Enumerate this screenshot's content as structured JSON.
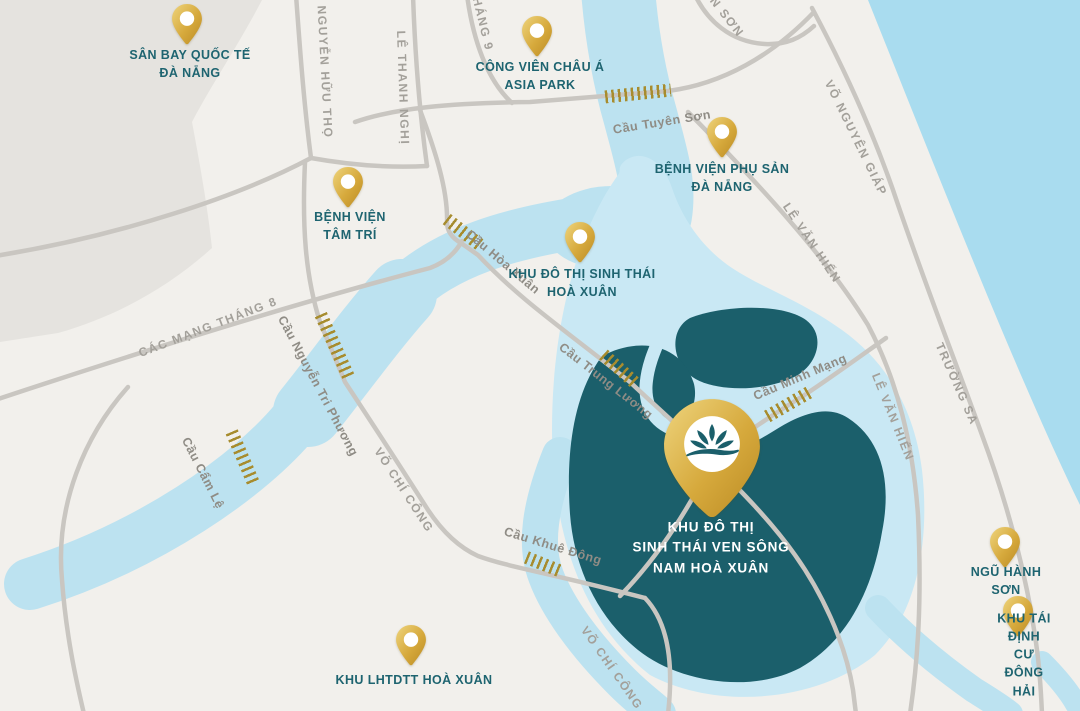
{
  "map_title": "Sơ đồ vị trí Khu đô thị sinh thái ven sông Nam Hoà Xuân - Đà Nẵng",
  "pois": {
    "airport": {
      "label": "SÂN BAY QUỐC TẾ\nĐÀ NẴNG"
    },
    "asia_park": {
      "label": "CÔNG VIÊN CHÂU Á\nASIA PARK"
    },
    "phu_san_hospital": {
      "label": "BỆNH VIỆN PHỤ SẢN\nĐÀ NẴNG"
    },
    "tam_tri_hospital": {
      "label": "BỆNH VIỆN\nTÂM TRÍ"
    },
    "hoa_xuan_eco": {
      "label": "KHU ĐÔ THỊ SINH THÁI\nHOÀ XUÂN"
    },
    "ngu_hanh_son": {
      "label": "NGŨ HÀNH SƠN"
    },
    "dong_hai": {
      "label": "KHU TÁI ĐỊNH CƯ\nĐÔNG HẢI"
    },
    "lhtdtt": {
      "label": "KHU LHTDTT HOÀ XUÂN"
    },
    "project": {
      "label": "KHU ĐÔ THỊ\nSINH THÁI VEN SÔNG\nNAM HOÀ XUÂN"
    }
  },
  "roads": {
    "nguyen_huu_tho": {
      "label": "NGUYỄN HỮU THỌ"
    },
    "le_thanh_nghi": {
      "label": "LÊ THANH NGHỊ"
    },
    "thang_9": {
      "label": "HÁNG 9"
    },
    "n_son": {
      "label": "N SƠN"
    },
    "vo_nguyen_giap": {
      "label": "VÕ NGUYÊN GIÁP"
    },
    "le_van_hien_n": {
      "label": "LÊ VĂN HIẾN"
    },
    "le_van_hien_s": {
      "label": "LÊ VĂN HIẾN"
    },
    "truong_sa": {
      "label": "TRƯỜNG SA"
    },
    "cach_mang_thang_8": {
      "label": "CÁC MẠNG THÁNG 8"
    },
    "vo_chi_cong_mid": {
      "label": "VÕ CHÍ CÔNG"
    },
    "vo_chi_cong_bot": {
      "label": "VÕ CHÍ CÔNG"
    }
  },
  "bridges": {
    "tuyen_son": {
      "label": "Cầu Tuyên Sơn"
    },
    "hoa_xuan": {
      "label": "Cầu Hòa Xuân"
    },
    "nguyen_tri_phuong": {
      "label": "Cầu Nguyễn Tri Phương"
    },
    "cam_le": {
      "label": "Cầu Cẩm Lệ"
    },
    "trung_luong": {
      "label": "Cầu Trung Lương"
    },
    "minh_mang": {
      "label": "Cầu Minh Mạng"
    },
    "khue_dong": {
      "label": "Cầu Khuê Đông"
    }
  },
  "colors": {
    "land": "#f2f0ec",
    "airport_zone": "#e5e3df",
    "sea": "#a9dcef",
    "river": "#bce2f0",
    "halo": "#c9e8f4",
    "project_area": "#1b5f6b",
    "road": "#c9c6c1",
    "pin_gold_light": "#eccf6f",
    "pin_gold_dark": "#bf8f28",
    "bridge_hatch": "#a78c2e",
    "poi_text": "#1e6470",
    "road_text": "#a3a09a",
    "project_text": "#ffffff"
  }
}
